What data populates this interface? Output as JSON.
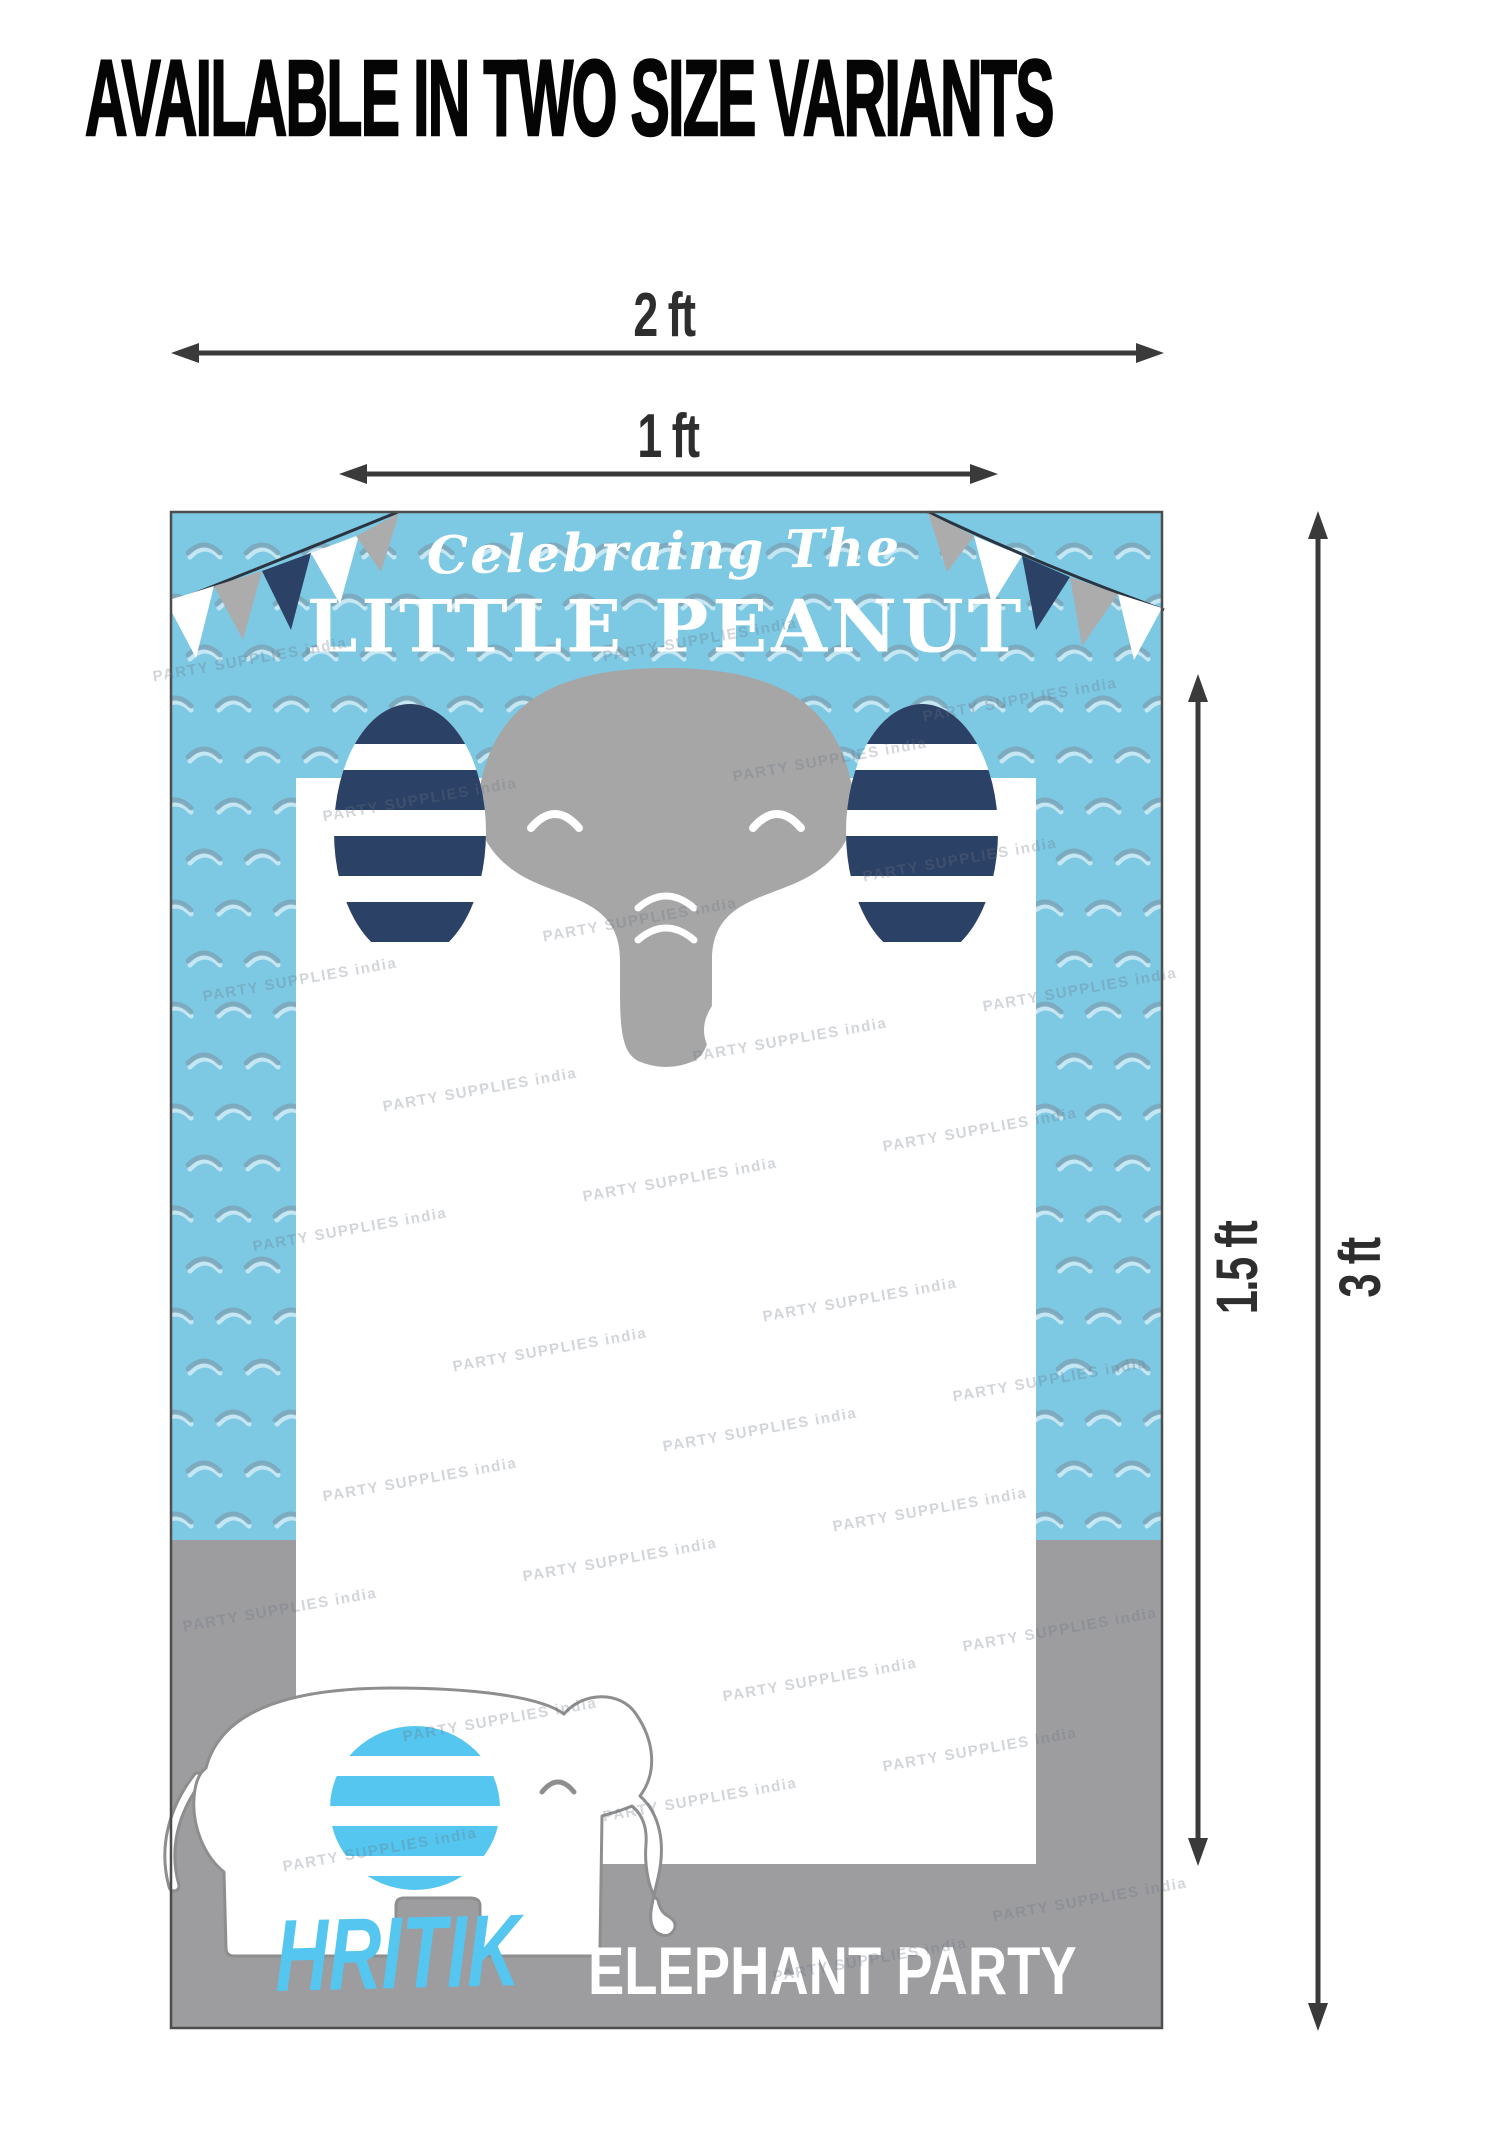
{
  "title": "AVAILABLE IN TWO SIZE VARIANTS",
  "dimensions": {
    "width_large": "2 ft",
    "width_small": "1 ft",
    "height_small": "1.5 ft",
    "height_large": "3 ft"
  },
  "poster": {
    "tagline": "Celebraing The",
    "heading": "LITTLE PEANUT",
    "child_name": "HRITIK",
    "subtitle": "ELEPHANT PARTY",
    "watermark": "PARTY SUPPLIES india",
    "colors": {
      "sky_blue": "#7DC9E4",
      "scallop": "#7BA6BA",
      "navy": "#2C4166",
      "gray_panel": "#9D9DA0",
      "elephant_gray": "#A6A6A6",
      "accent_blue": "#55C6EF",
      "flag_gray": "#ACACAC",
      "outline_gray": "#8E8E8E",
      "arrow": "#3A3A3A"
    }
  }
}
